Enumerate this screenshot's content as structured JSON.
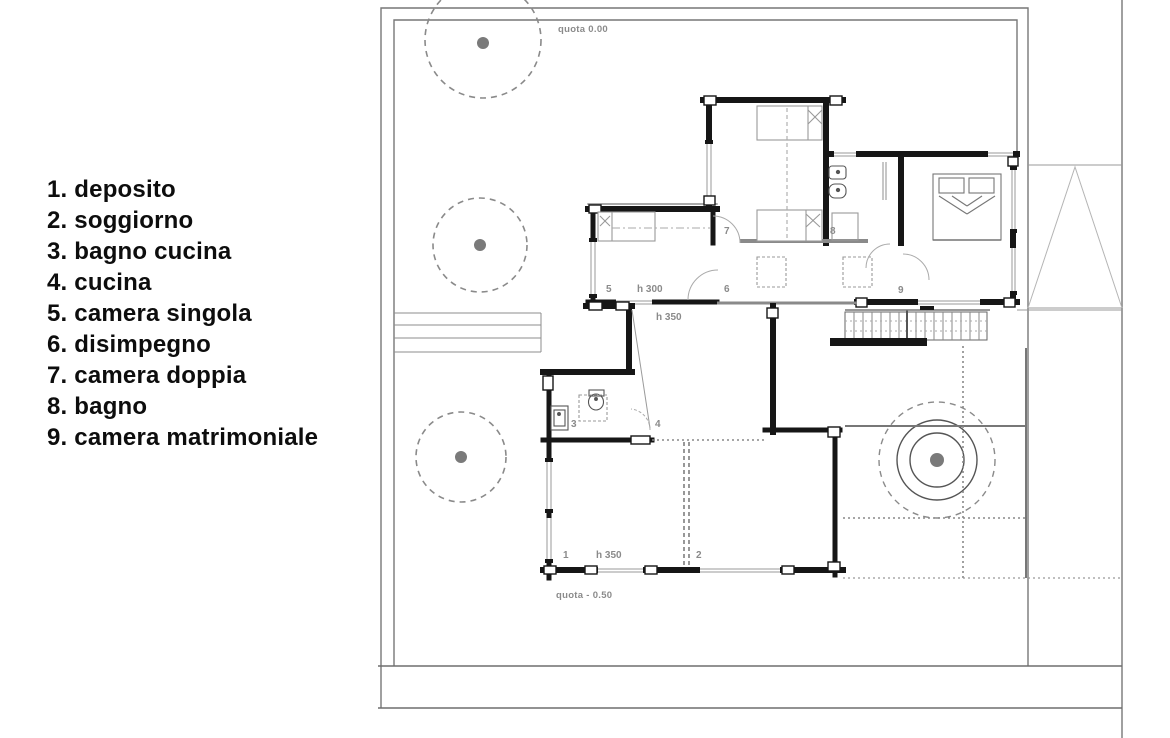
{
  "legend": {
    "items": [
      "1. deposito",
      "2. soggiorno",
      "3. bagno cucina",
      "4. cucina",
      "5. camera singola",
      "6. disimpegno",
      "7. camera doppia",
      "8. bagno",
      "9. camera matrimoniale"
    ]
  },
  "plan": {
    "quota_upper": "quota 0.00",
    "quota_lower": "quota - 0.50",
    "height_upper": "h 300",
    "height_kitchen": "h 350",
    "height_lower": "h 350",
    "numbers": {
      "n1": "1",
      "n2": "2",
      "n3": "3",
      "n4": "4",
      "n5": "5",
      "n6": "6",
      "n7": "7",
      "n8": "8",
      "n9": "9"
    },
    "colors": {
      "wall": "#161616",
      "thin_line": "#8e8e8e",
      "label": "#8a8a8a",
      "background": "#ffffff"
    }
  }
}
